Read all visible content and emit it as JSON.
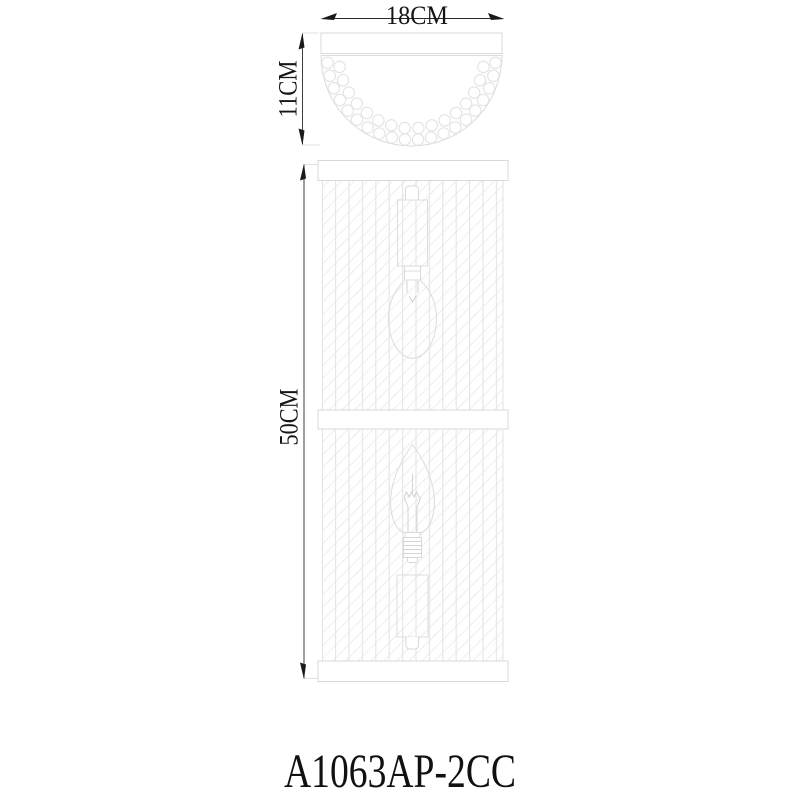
{
  "product": {
    "code": "A1063AP-2CC"
  },
  "dimensions": {
    "width_label": "18CM",
    "height_label": "11CM",
    "body_height_label": "50CM"
  },
  "colors": {
    "dimension_ink": "#1c1c1c",
    "outline_light": "#d9d9d9",
    "background": "#ffffff"
  }
}
